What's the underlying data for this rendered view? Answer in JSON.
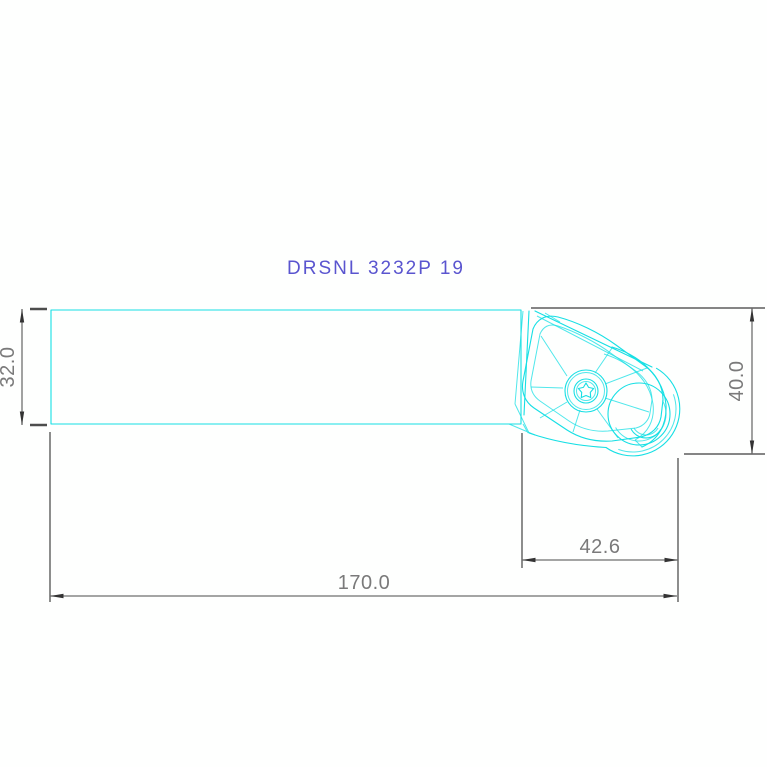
{
  "title": {
    "label": "DRSNL 3232P 19"
  },
  "drawing": {
    "kind": "technical-drawing",
    "subject": "turning tool holder, side view with round insert and clamp"
  },
  "dimensions": {
    "shank_height": {
      "label": "32.0",
      "orientation": "vertical"
    },
    "overall_height": {
      "label": "40.0",
      "orientation": "vertical"
    },
    "head_length": {
      "label": "42.6",
      "orientation": "horizontal"
    },
    "overall_length": {
      "label": "170.0",
      "orientation": "horizontal"
    }
  },
  "colors": {
    "part_line": "#16dfe4",
    "part_line_light": "#8aeef1",
    "dimension_line": "#6f6f6f",
    "extension_tick": "#4d4d4d",
    "dimension_text": "#7a7a7a",
    "arrow": "#333333",
    "title_text": "#5a55cf",
    "background": "#fefffe"
  }
}
